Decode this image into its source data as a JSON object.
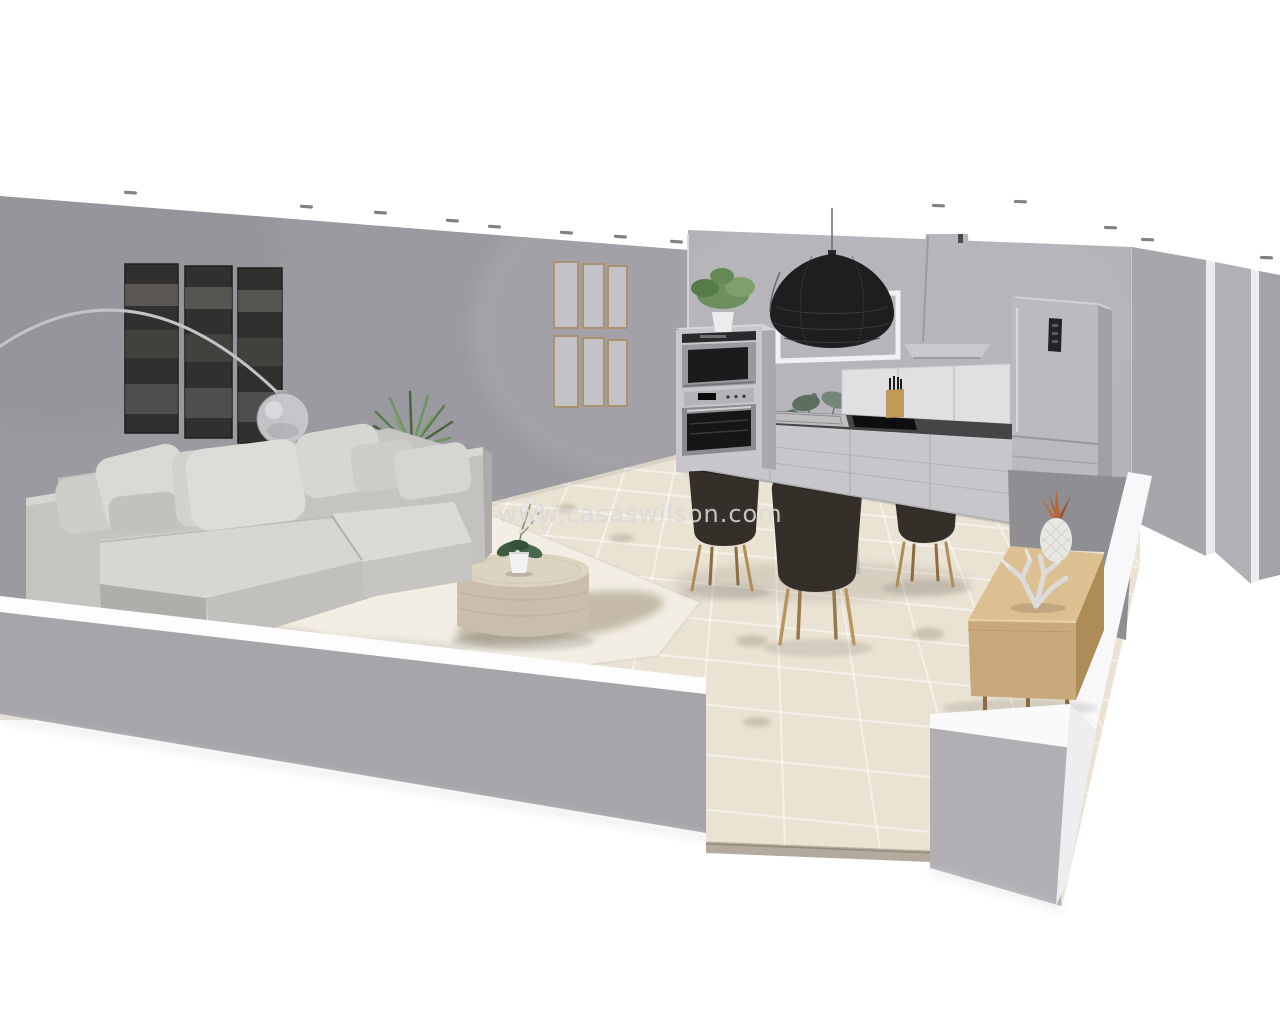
{
  "watermark": {
    "text": "www.casaswilson.com"
  },
  "scene": {
    "description": "3D dollhouse-style cutaway render of an open-plan living room, dining area and kitchen",
    "objects": [
      "left-wall-art-triptych",
      "arc-floor-lamp",
      "sectional-sofa",
      "throw-pillows",
      "area-rug",
      "round-coffee-table",
      "potted-orchid",
      "palm-plant",
      "gallery-frames-grid",
      "oven-microwave-column",
      "plant-on-oven",
      "rattan-pendant-lamp",
      "wall-frame",
      "range-hood",
      "kitchen-counter",
      "sink",
      "cooktop",
      "knife-block",
      "fridge-freezer",
      "round-dining-table",
      "dining-chairs",
      "eucalyptus-vase",
      "wooden-sideboard",
      "ceramic-pineapple",
      "coral-ornament",
      "tiled-floor",
      "ceiling-spotlights",
      "cutaway-walls",
      "doorway-opening"
    ]
  },
  "colors": {
    "background": "#ffffff",
    "left_wall": "#9b9aa0",
    "back_wall": "#b4b3b8",
    "front_wall": "#a6a5aa",
    "wall_cut_top": "#fbfbfd",
    "floor": "#eae3d4",
    "rug": "#f2eee4",
    "sofa": "#c6c4c0",
    "chair": "#352f29",
    "chair_leg": "#b08c58",
    "table_top": "#ece8de",
    "sideboard_wood": "#c9a97c",
    "pendant": "#1e1e20",
    "appliance": "#bbbabf",
    "art": "#31302e",
    "watermark": "#d9d9d9"
  }
}
